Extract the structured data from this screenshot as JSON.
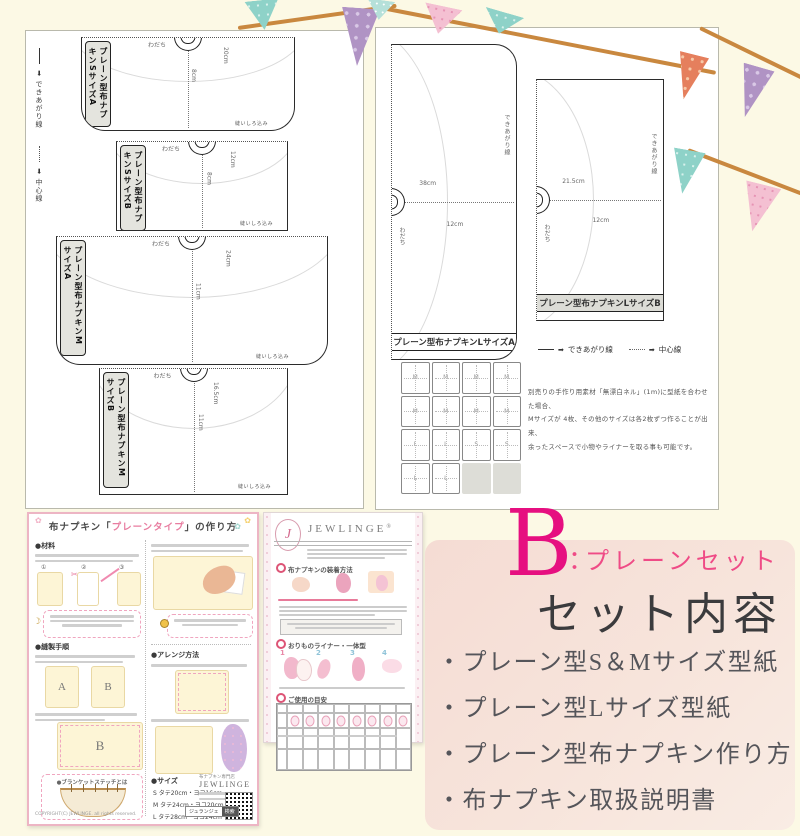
{
  "icons": {
    "arrow": "➡",
    "monogram": "J",
    "flower": "✿",
    "moon": "☽",
    "scissors": "✂",
    "reg_mark": "®"
  },
  "sheet_sm": {
    "legend": [
      {
        "label": "できあがり線"
      },
      {
        "label": "中心線"
      }
    ],
    "patterns": [
      {
        "name": "プレーン型布ナプキンSサイズA",
        "fold": "わだち",
        "width": "20cm",
        "height": "8cm",
        "note": "縫いしろ込み"
      },
      {
        "name": "プレーン型布ナプキンSサイズB",
        "fold": "わだち",
        "width": "12cm",
        "height": "8cm",
        "note": "縫いしろ込み"
      },
      {
        "name": "プレーン型布ナプキンMサイズA",
        "fold": "わだち",
        "width": "24cm",
        "height": "11cm",
        "note": "縫いしろ込み"
      },
      {
        "name": "プレーン型布ナプキンMサイズB",
        "fold": "わだち",
        "width": "16.5cm",
        "height": "11cm",
        "note": "縫いしろ込み"
      }
    ]
  },
  "sheet_l": {
    "patterns": [
      {
        "name": "プレーン型布ナプキンLサイズA",
        "fold": "わだち",
        "length": "38cm",
        "width": "12cm",
        "finish": "できあがり線"
      },
      {
        "name": "プレーン型布ナプキンLサイズB",
        "fold": "わだち",
        "length": "21.5cm",
        "width": "12cm",
        "finish": "できあがり線"
      }
    ],
    "legend_finish": "できあがり線",
    "legend_center": "中心線",
    "cutting_grid": [
      "M",
      "M",
      "M",
      "M",
      "M",
      "M",
      "M",
      "M",
      "L",
      "L",
      "S",
      "S",
      "L",
      "L",
      "",
      ""
    ],
    "note_lines": [
      "別売りの手作り用素材「無漂白ネル」(1m)に型紙を合わせた場合、",
      "Mサイズが 4枚、その他のサイズは各2枚ずつ作ることが出来、",
      "余ったスペースで小物やライナーを取る事も可能です。"
    ]
  },
  "howto": {
    "title_pre": "布ナプキン「",
    "title_em": "プレーンタイプ",
    "title_post": "」の作り方",
    "sec_materials": "●材料",
    "sec_steps": "●縫製手順",
    "sec_arrange": "●アレンジ方法",
    "sec_stitch": "●ブランケットステッチとは",
    "sec_size": "●サイズ",
    "nums": [
      "①",
      "②",
      "③"
    ],
    "label_a": "A",
    "label_b": "B",
    "big_b": "B",
    "sizes": [
      "S タテ20cm・ヨコ16cm",
      "M タテ24cm・ヨコ20cm",
      "L タテ28cm・ヨコ24cm"
    ],
    "shop_small": "布ナプキン専門店",
    "brand": "JEWLINGE",
    "search_label": "ジュランジェ",
    "search_btn": "検索",
    "copyright": "COPYRIGHT(C) JEWLINGE. all rights reserved."
  },
  "care": {
    "brand": "JEWLINGE",
    "sec1": "布ナプキンの装着方法",
    "sec2": "おりものライナー・一体型",
    "sec3": "ご使用の目安",
    "nums": [
      "1",
      "2",
      "3",
      "4"
    ]
  },
  "set_panel": {
    "letter": "B",
    "colon": "：",
    "set_name": "プレーンセット",
    "heading": "セット内容",
    "items": [
      "・プレーン型S＆Mサイズ型紙",
      "・プレーン型Lサイズ型紙",
      "・プレーン型布ナプキン作り方",
      "・布ナプキン取扱説明書"
    ],
    "accent_color": "#e60f80"
  }
}
